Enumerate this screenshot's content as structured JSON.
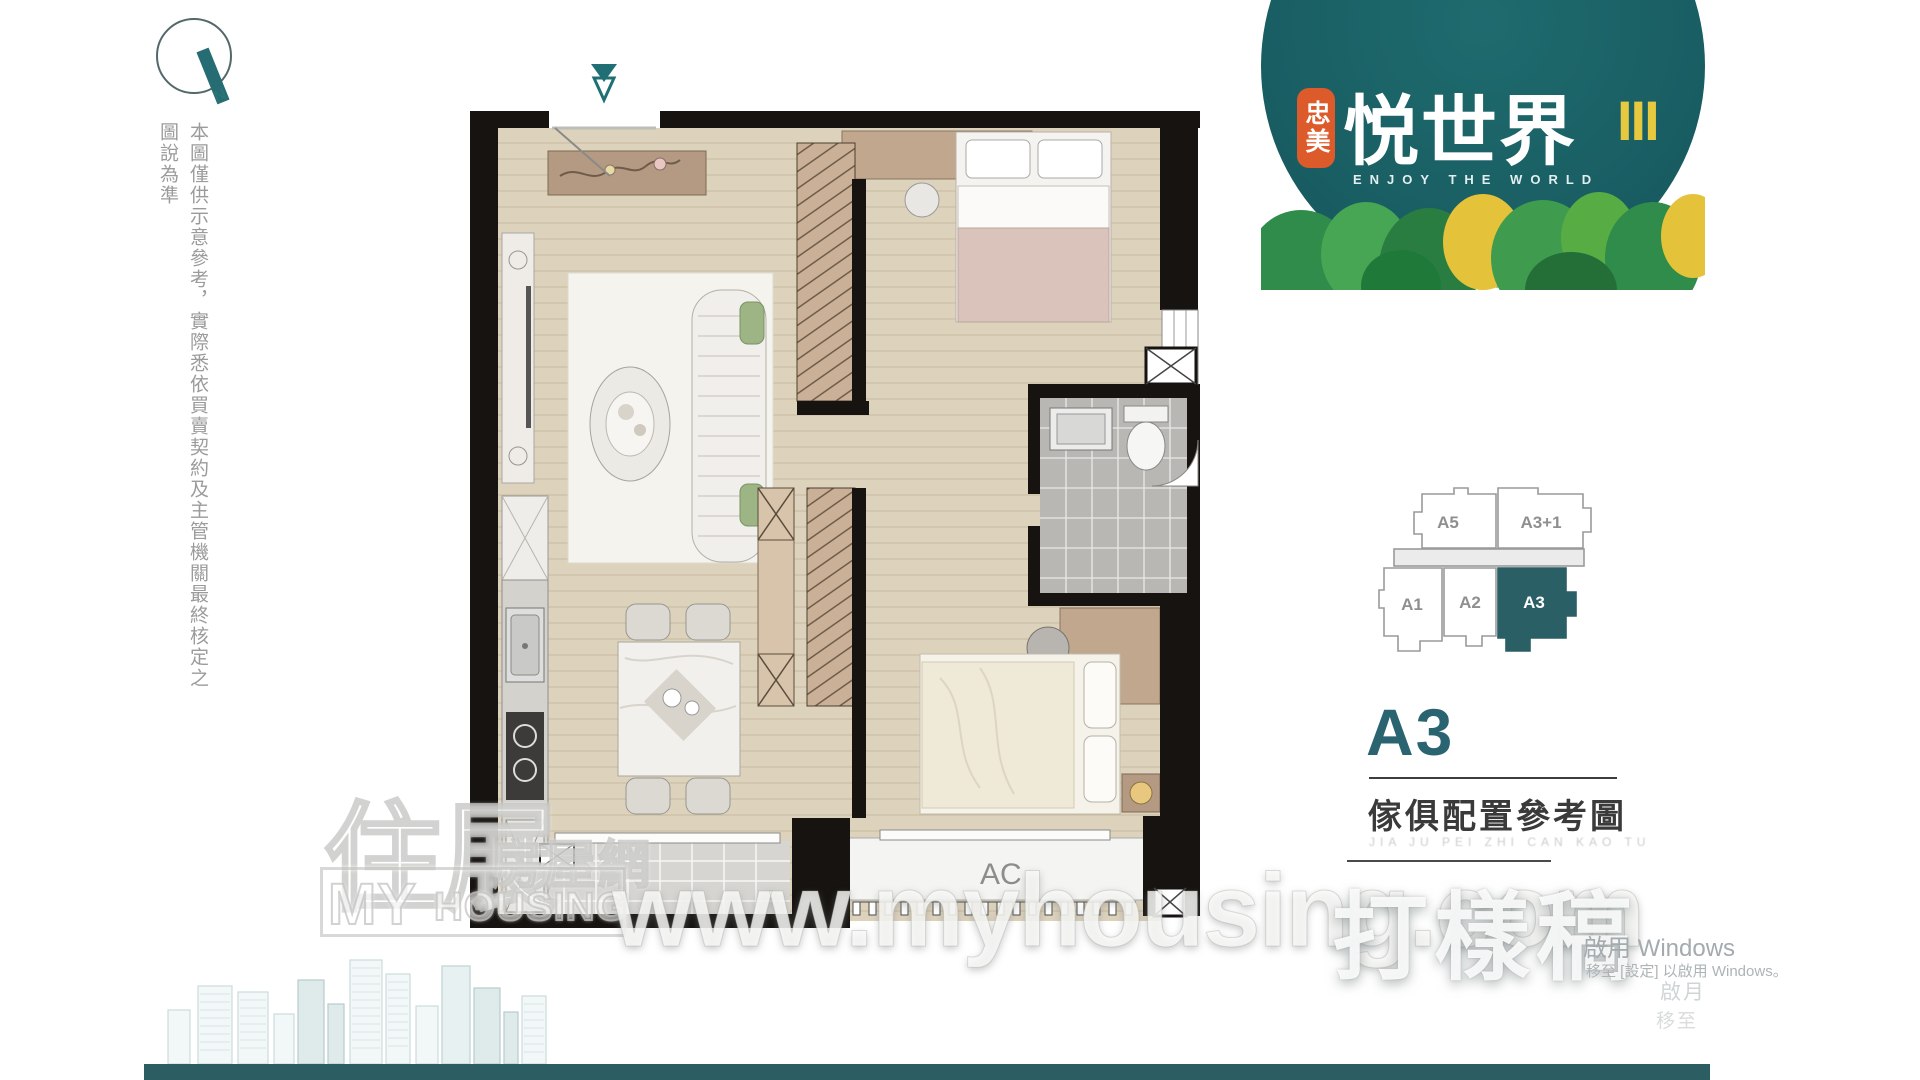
{
  "compass": {
    "label": "N"
  },
  "disclaimer": {
    "text": "本圖僅供示意參考，實際悉依買賣契約及主管機關最終核定之圖說為準"
  },
  "floor_plan": {
    "ac_label": "AC"
  },
  "logo": {
    "badge": "忠美",
    "title": "悦世界",
    "roman": "III",
    "subtitle": "ENJOY THE WORLD",
    "colors": {
      "circle": "#1b6368",
      "badge": "#dd5a2b",
      "roman": "#e7c93f"
    }
  },
  "key_plan": {
    "units": [
      {
        "label": "A5"
      },
      {
        "label": "A3+1"
      },
      {
        "label": "A1"
      },
      {
        "label": "A2"
      },
      {
        "label": "A3"
      }
    ],
    "selected": "A3",
    "selected_color": "#2b5f66"
  },
  "unit_info": {
    "unit": "A3",
    "caption": "傢俱配置參考圖",
    "caption_sub": "JIA JU PEI ZHI CAN KAO TU"
  },
  "watermarks": {
    "url": "www.myhousing.com",
    "stamp": "打樣稿",
    "brand_zh_main": "住展",
    "brand_zh_sub": "房屋網",
    "brand_en_1": "MY",
    "brand_en_2": "HOUSING"
  },
  "windows_activation": {
    "line1": "啟用 Windows",
    "line2": "移至 [設定] 以啟用 Windows。",
    "ghost1": "啟月",
    "ghost2": "移至"
  }
}
